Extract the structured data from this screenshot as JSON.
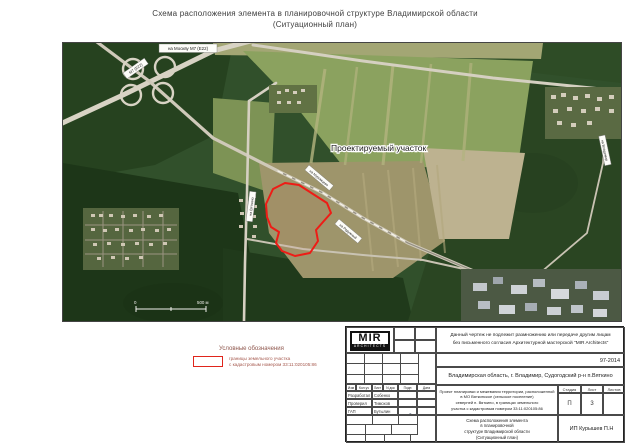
{
  "page_title": {
    "line1": "Схема расположения элемента в планировочной структуре Владимирской области",
    "line2": "(Ситуационный план)"
  },
  "map": {
    "project_site_label": "Проектируемый участок",
    "road_labels": [
      {
        "text": "на Москву М7 (Е22)"
      },
      {
        "text": "М7 (Е22)"
      },
      {
        "text": "на Вяткино"
      },
      {
        "text": "на Муромцево"
      },
      {
        "text": "на Радужный"
      },
      {
        "text": "на Владимир"
      }
    ],
    "scale": {
      "zero": "0",
      "label": "500 м"
    },
    "parcel_color": "#ee1c16"
  },
  "legend": {
    "title": "Условные обозначения",
    "item_line1": "границы земельного участка",
    "item_line2": "с кадастровым номером 33:11:020105:86",
    "swatch_color": "#e0251c"
  },
  "stamp": {
    "logo_text": "MIR",
    "logo_sub": "ARCHITECTS",
    "disclaimer_line1": "Данный чертеж не подлежит размножению или передаче другим лицам",
    "disclaimer_line2": "без письменного согласия Архитектурной мастерской \"MIR Architects\"",
    "project_number": "97-2014",
    "location": "Владимирская область, г. Владимир, Судогодский р-н п.Вяткино",
    "header": {
      "izm": "Изм",
      "kol": "Кол.уч",
      "list": "Лист",
      "ndok": "N док",
      "podp": "Подп",
      "data": "Дата"
    },
    "rows": [
      {
        "role": "Разработал",
        "name": "Собенко Ю.И"
      },
      {
        "role": "Проверил",
        "name": "Тимохов Д.А"
      },
      {
        "role": "ГАП",
        "name": "Бутылин И.П"
      }
    ],
    "project_desc": {
      "line1": "Проект планировки и межевания территории, расположенной",
      "line2": "в МО Вяткинское (сельское поселение)",
      "line3": "северней п. Вяткино, в границах земельного",
      "line4": "участка с кадастровым номером 33:11:020105:86"
    },
    "stage": {
      "stage_label": "Стадия",
      "sheet_label": "Лист",
      "sheets_label": "Листов",
      "stage_value": "П",
      "sheet_value": "3",
      "sheets_value": ""
    },
    "scheme": {
      "line1": "Схема расположения элемента",
      "line2": "в планировочной",
      "line3": "структуре Владимирской области",
      "line4": "(Ситуационный план)"
    },
    "company": "ИП Курышев П.Н"
  }
}
